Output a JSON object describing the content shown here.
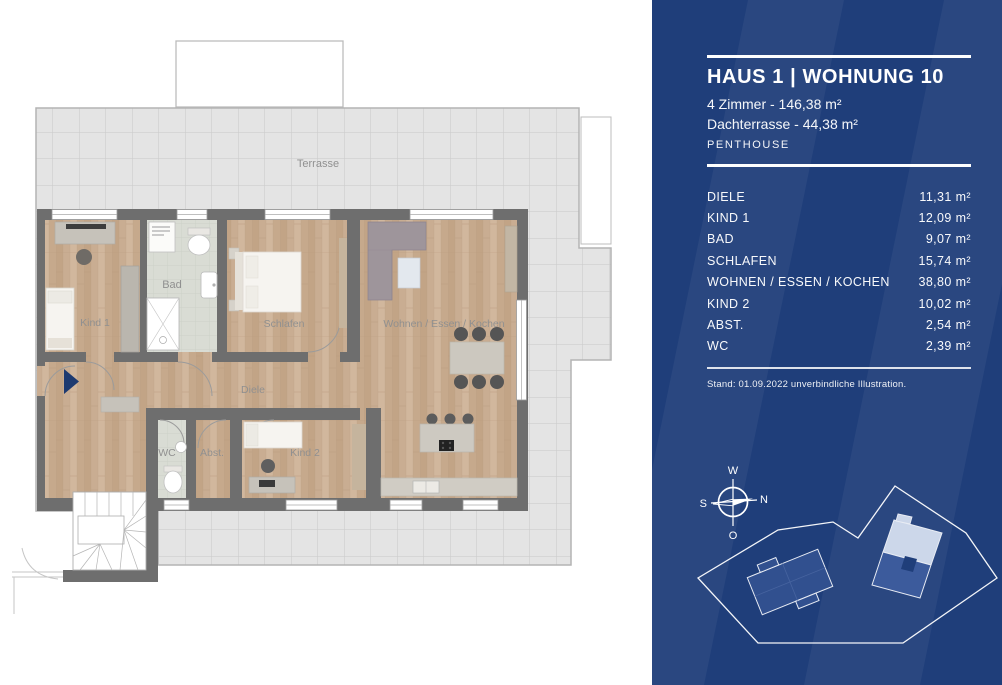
{
  "floorplan": {
    "labels": {
      "terrasse": "Terrasse",
      "kind1": "Kind 1",
      "bad": "Bad",
      "schlafen": "Schlafen",
      "wohnen": "Wohnen / Essen / Kochen",
      "diele": "Diele",
      "wc": "WC",
      "abst": "Abst.",
      "kind2": "Kind 2"
    },
    "colors": {
      "wall": "#6e6e6e",
      "wood": "#c9ad92",
      "bath_tile": "#d9dcd4",
      "terrace": "#e4e4e4",
      "entry_arrow": "#1d3a70"
    }
  },
  "panel": {
    "title": "HAUS 1 | WOHNUNG 10",
    "line1": "4 Zimmer - 146,38 m²",
    "line2": "Dachterrasse - 44,38 m²",
    "type_label": "PENTHOUSE",
    "rooms": [
      {
        "label": "DIELE",
        "area": "11,31 m²"
      },
      {
        "label": "KIND 1",
        "area": "12,09 m²"
      },
      {
        "label": "BAD",
        "area": "9,07 m²"
      },
      {
        "label": "SCHLAFEN",
        "area": "15,74 m²"
      },
      {
        "label": "WOHNEN / ESSEN / KOCHEN",
        "area": "38,80 m²"
      },
      {
        "label": "KIND 2",
        "area": "10,02 m²"
      },
      {
        "label": "ABST.",
        "area": "2,54 m²"
      },
      {
        "label": "WC",
        "area": "2,39 m²"
      }
    ],
    "note": "Stand: 01.09.2022 unverbindliche Illustration.",
    "compass": {
      "w": "W",
      "n": "N",
      "s": "S",
      "o": "O"
    },
    "colors": {
      "panel_bg": "#1f3e7a",
      "stripe": "rgba(255,255,255,0.05)",
      "building": "#31508f",
      "unit_highlight": "#ccd7ea"
    }
  }
}
